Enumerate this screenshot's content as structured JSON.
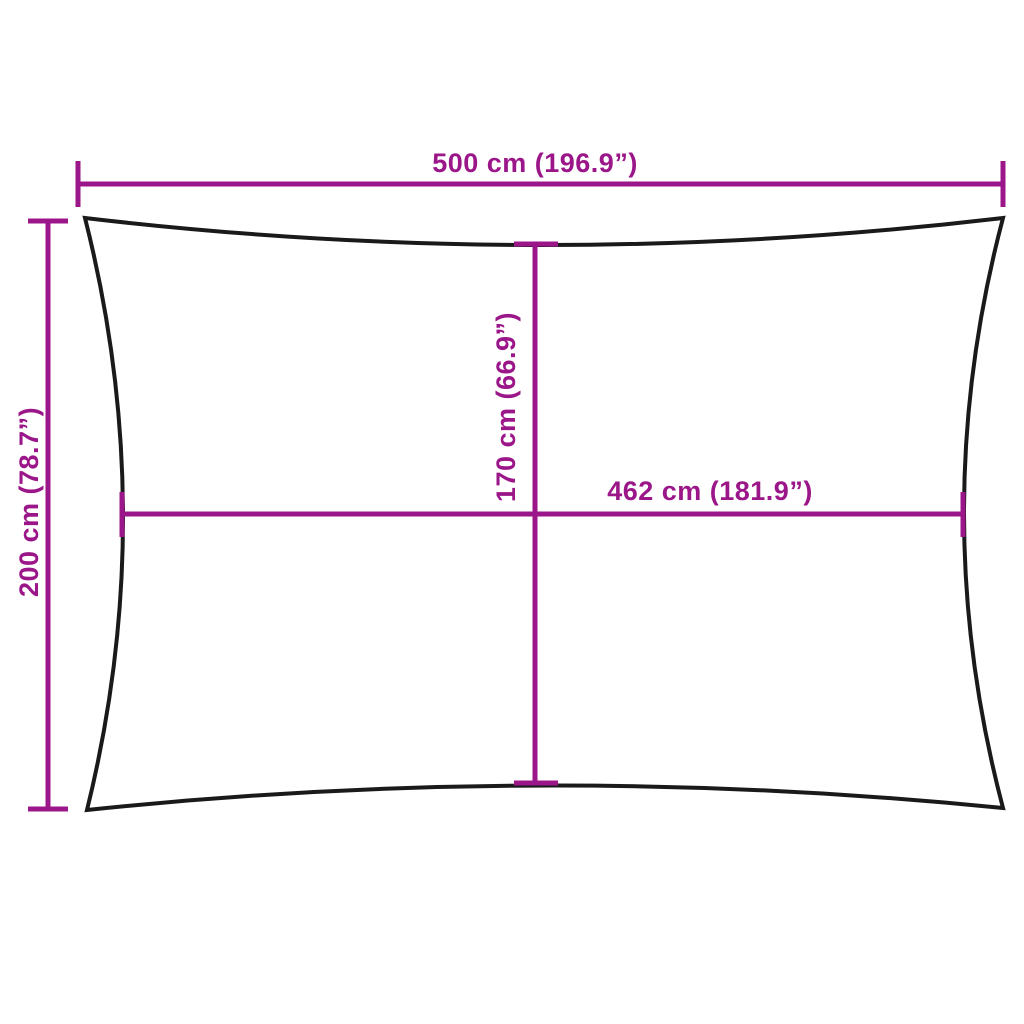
{
  "figure": {
    "background_color": "#FFFFFF",
    "outline_color": "#1A1A1A",
    "accent_color": "#9B1688",
    "shape": "rectangle-with-concave-edges",
    "labels": {
      "outer_width": "500 cm (196.9”)",
      "outer_height": "200 cm (78.7”)",
      "inner_height": "170 cm (66.9”)",
      "inner_width": "462 cm (181.9”)"
    }
  }
}
